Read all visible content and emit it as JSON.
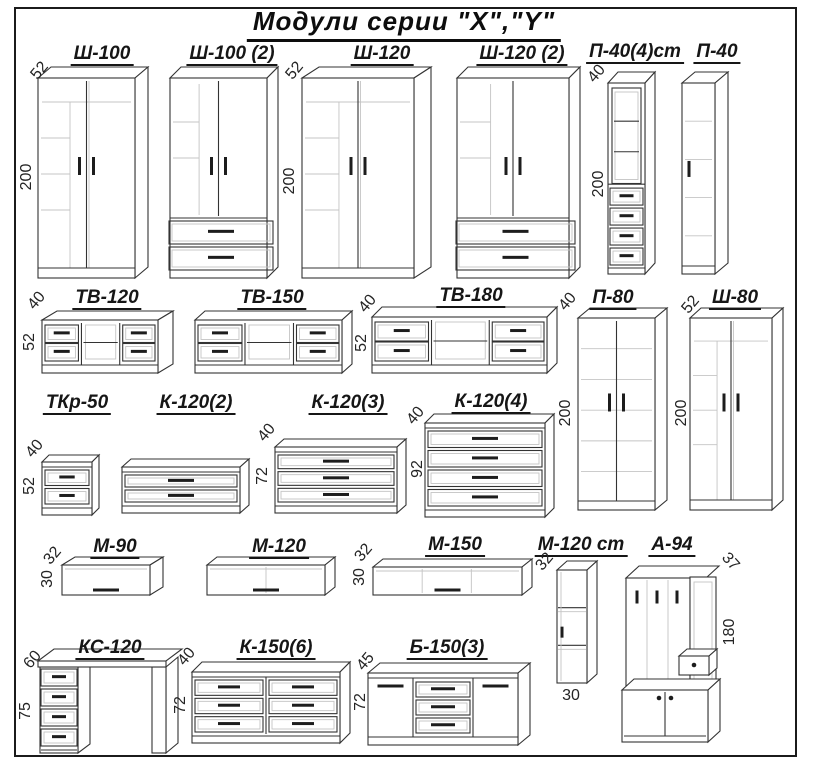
{
  "title": "Модули серии  \"X\",\"Y\"",
  "colors": {
    "line": "#333333",
    "interior_light": "#c4c4c4",
    "text": "#161616",
    "background": "#ffffff"
  },
  "modules": [
    {
      "id": "sh-100",
      "label": "Ш-100",
      "type": "wardrobe2",
      "dims": {
        "depth": "52",
        "height": "200"
      }
    },
    {
      "id": "sh-100-2",
      "label": "Ш-100 (2)",
      "type": "wardrobe2drawers",
      "dims": {}
    },
    {
      "id": "sh-120",
      "label": "Ш-120",
      "type": "wardrobe2",
      "dims": {
        "depth": "52",
        "height": "200"
      }
    },
    {
      "id": "sh-120-2",
      "label": "Ш-120 (2)",
      "type": "wardrobe2drawers",
      "dims": {}
    },
    {
      "id": "p-40-4st",
      "label": "П-40(4)ст",
      "type": "displayDrawers",
      "dims": {
        "depth": "40",
        "height": "200"
      }
    },
    {
      "id": "p-40",
      "label": "П-40",
      "type": "pencil1",
      "dims": {}
    },
    {
      "id": "tv-120",
      "label": "ТВ-120",
      "type": "tvstand",
      "dims": {
        "depth": "40",
        "height": "52"
      }
    },
    {
      "id": "tv-150",
      "label": "ТВ-150",
      "type": "tvstand",
      "dims": {}
    },
    {
      "id": "tv-180",
      "label": "ТВ-180",
      "type": "tvstand",
      "dims": {
        "depth": "40",
        "height": "52"
      }
    },
    {
      "id": "p-80",
      "label": "П-80",
      "type": "cab2doorsTall",
      "dims": {
        "depth": "40",
        "height": "200"
      }
    },
    {
      "id": "sh-80",
      "label": "Ш-80",
      "type": "wardrobe2",
      "dims": {
        "depth": "52",
        "height": "200"
      }
    },
    {
      "id": "tkr-50",
      "label": "ТКр-50",
      "type": "chest2",
      "dims": {
        "depth": "40",
        "height": "52"
      }
    },
    {
      "id": "k-120-2",
      "label": "К-120(2)",
      "type": "chest2",
      "dims": {}
    },
    {
      "id": "k-120-3",
      "label": "К-120(3)",
      "type": "chest3",
      "dims": {
        "depth": "40",
        "height": "72"
      }
    },
    {
      "id": "k-120-4",
      "label": "К-120(4)",
      "type": "chest4",
      "dims": {
        "depth": "40",
        "height": "92"
      }
    },
    {
      "id": "m-90",
      "label": "М-90",
      "type": "wallshelf0",
      "dims": {
        "depth": "32",
        "height": "30"
      }
    },
    {
      "id": "m-120",
      "label": "М-120",
      "type": "wallshelf1",
      "dims": {}
    },
    {
      "id": "m-150",
      "label": "М-150",
      "type": "wallshelf2",
      "dims": {
        "depth": "32",
        "height": "30"
      }
    },
    {
      "id": "m-120-st",
      "label": "М-120 ст",
      "type": "vertshelf",
      "dims": {
        "depth": "32",
        "width": "30"
      }
    },
    {
      "id": "a-94",
      "label": "А-94",
      "type": "hallway",
      "dims": {
        "depth": "37",
        "height": "180"
      }
    },
    {
      "id": "ks-120",
      "label": "КС-120",
      "type": "desk",
      "dims": {
        "depth": "60",
        "height": "75"
      }
    },
    {
      "id": "k-150-6",
      "label": "К-150(6)",
      "type": "chest6",
      "dims": {
        "depth": "40",
        "height": "72"
      }
    },
    {
      "id": "b-150-3",
      "label": "Б-150(3)",
      "type": "sideboard3",
      "dims": {
        "depth": "45",
        "height": "72"
      }
    }
  ]
}
